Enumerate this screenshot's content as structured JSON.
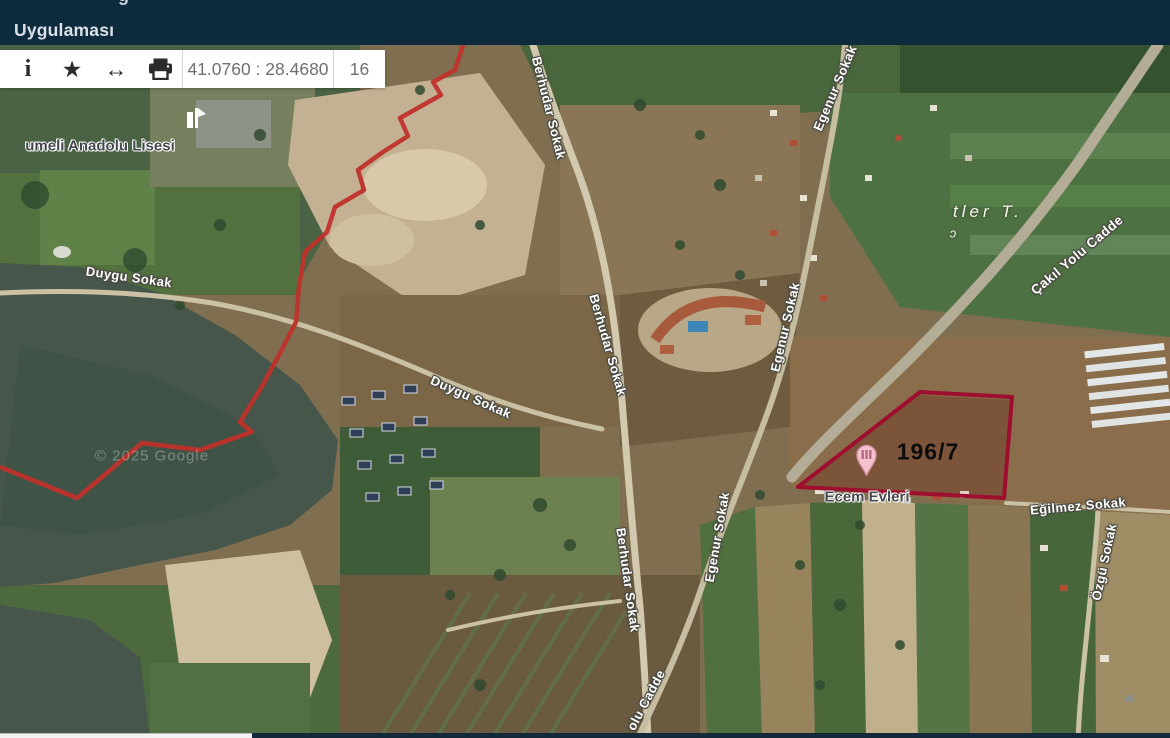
{
  "header": {
    "clipped_glyph": "ğ",
    "title": "Uygulaması"
  },
  "toolbar": {
    "info_icon": "i",
    "favorite_icon": "★",
    "extent_icon": "↔",
    "print_icon": "printer-glyph",
    "coordinates": "41.0760 : 28.4680",
    "zoom_level": "16"
  },
  "map": {
    "labels": {
      "school": "umeli Anadolu Lisesi",
      "duygu1": "Duygu Sokak",
      "duygu2": "Duygu Sokak",
      "berhudar1": "Berhudar Sokak",
      "berhudar2": "Berhudar Sokak",
      "berhudar3": "Berhudar Sokak",
      "egenur1": "Egenur Sokak",
      "egenur2": "Egenur Sokak",
      "egenur3": "Egenur Sokak",
      "cakil": "Çakıl Yolu Cadde",
      "area_partial": "tler T.",
      "stray_glyph": "ɔ",
      "parcel": "196/7",
      "ecem": "Ecem Evleri",
      "egilmez": "Eğilmez Sokak",
      "ozgu": "Özgü Sokak",
      "olu_cadde": "olu Cadde",
      "watermark": "© 2025 Google"
    },
    "colors": {
      "boundary_red": "#c0312b",
      "parcel_red": "#9e0e2e",
      "header_bg": "#0e2a3d"
    }
  }
}
